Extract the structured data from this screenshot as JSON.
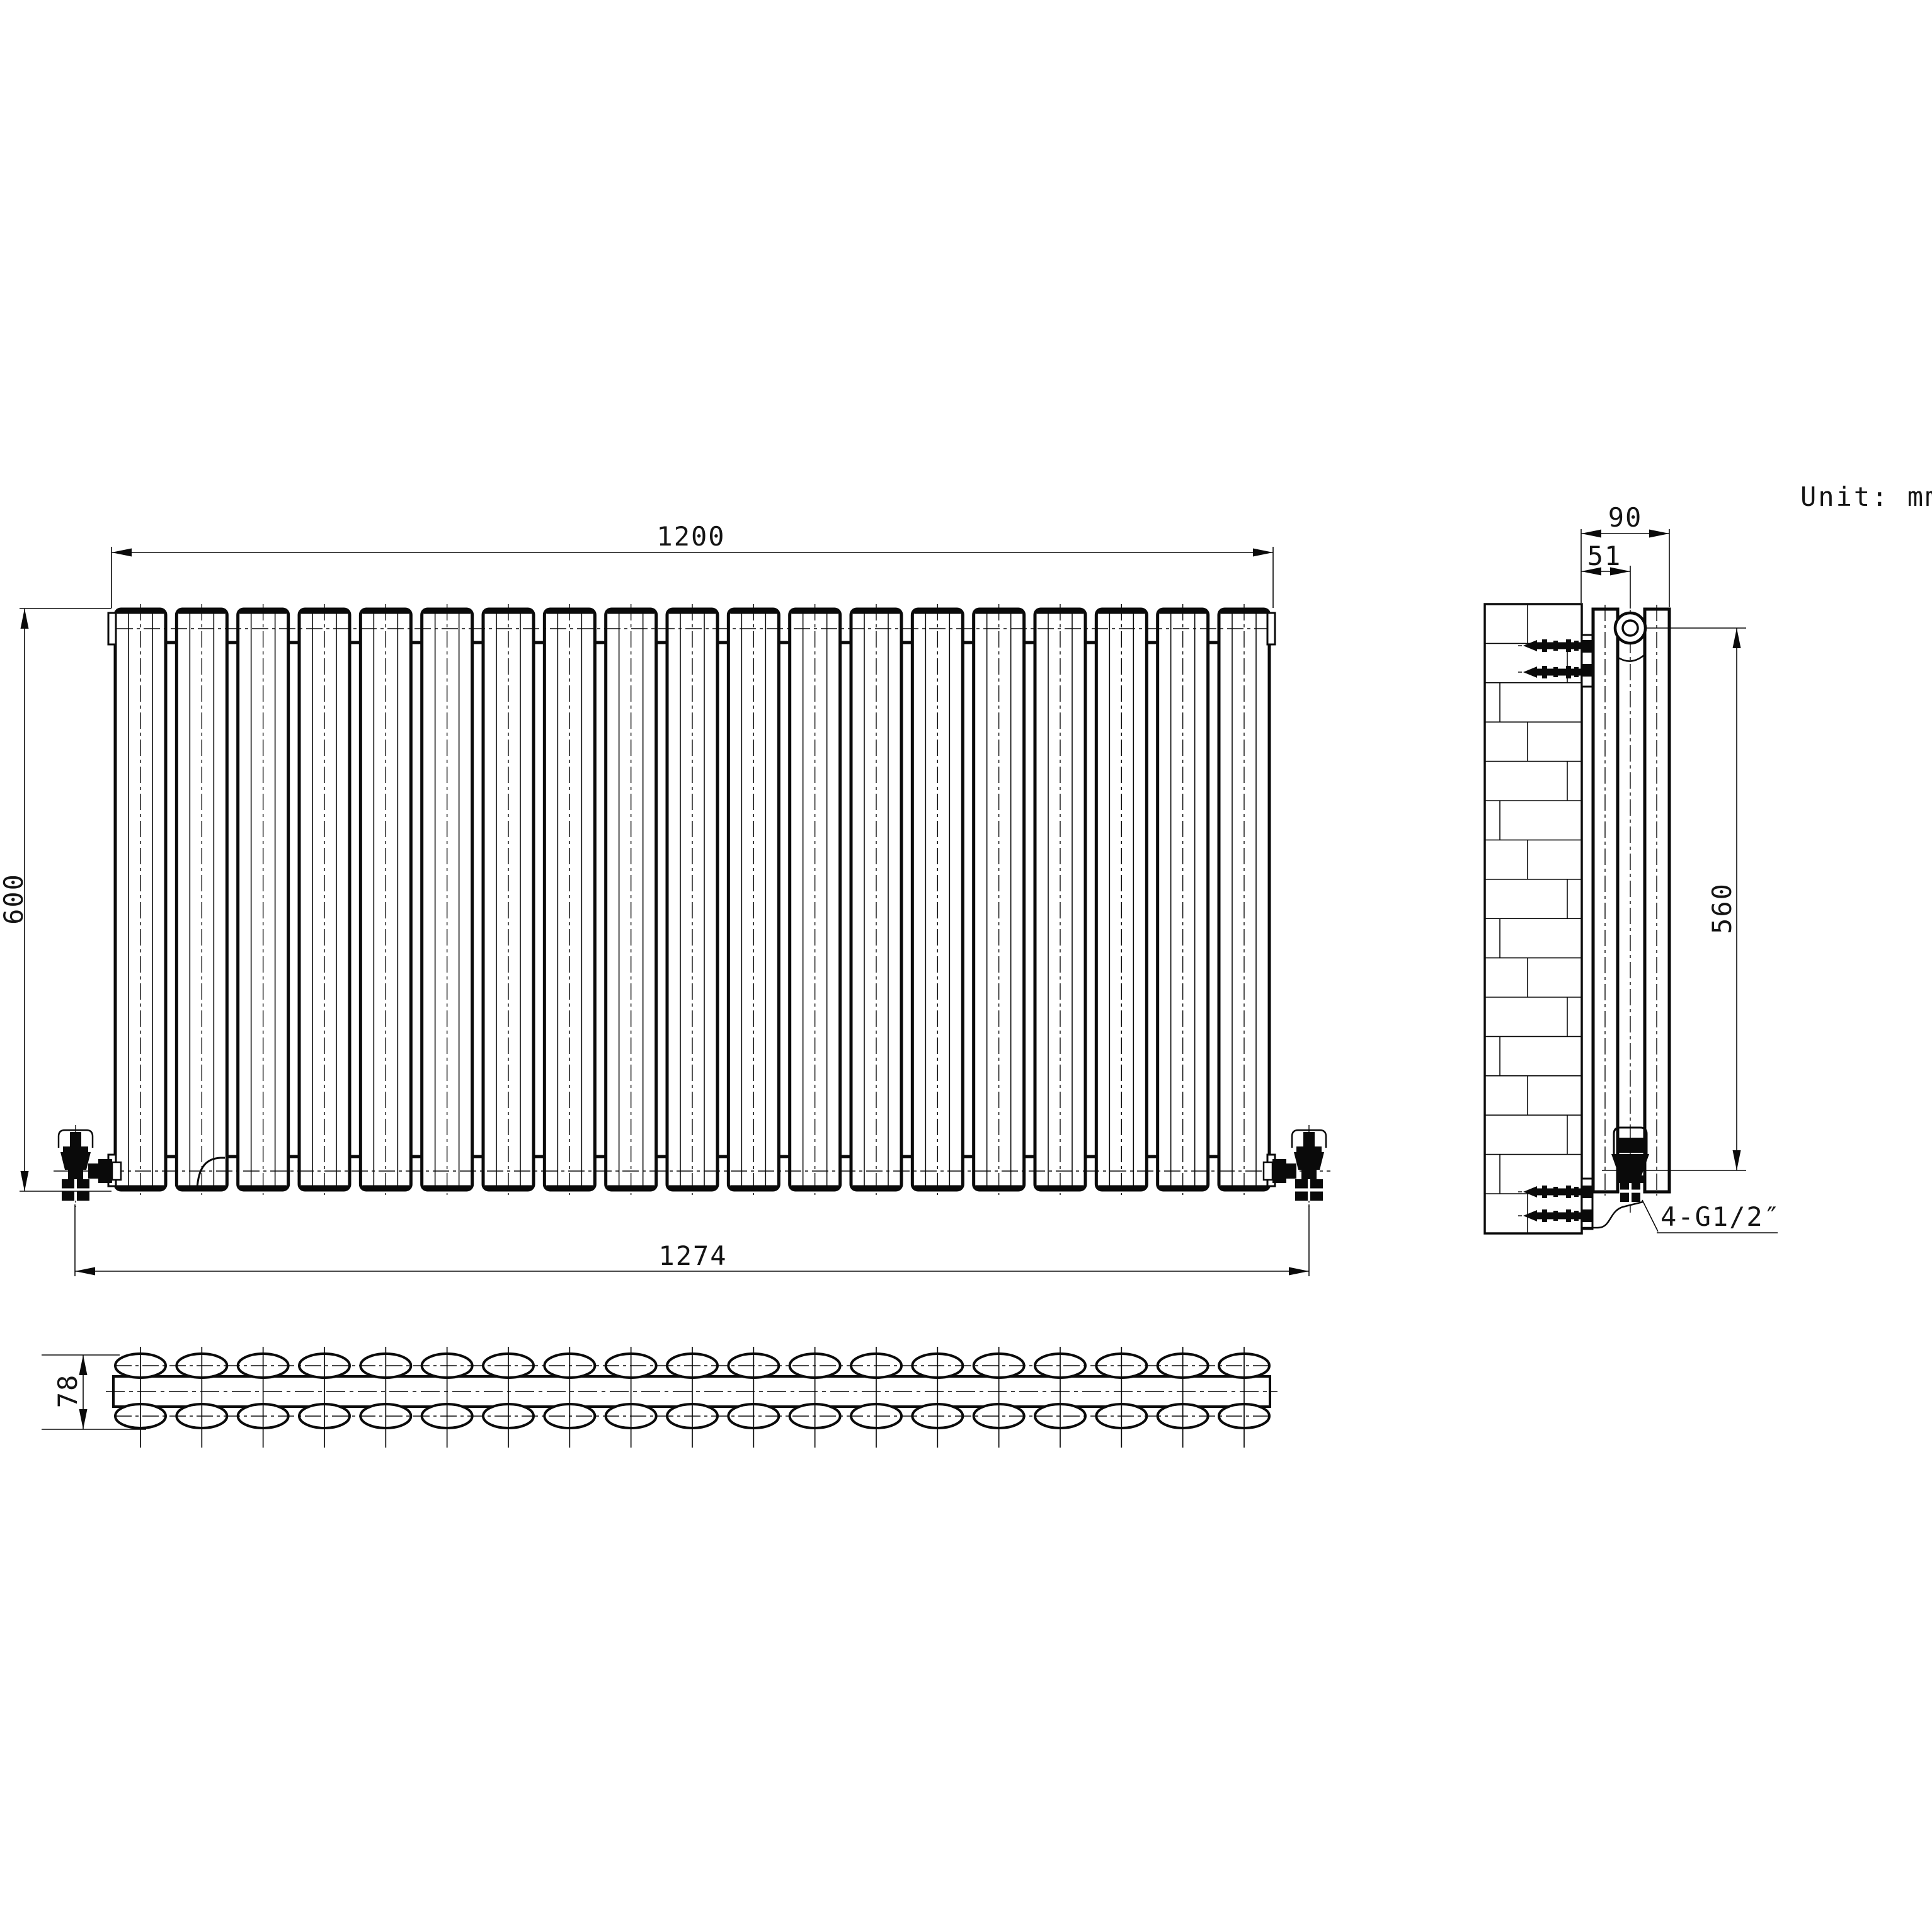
{
  "unit_label": "Unit: mm",
  "colors": {
    "line": "#0a0a0a",
    "background": "#ffffff"
  },
  "front_view": {
    "panel_count": 19,
    "width_label": "1200",
    "height_label": "600",
    "valve_span_label": "1274"
  },
  "side_view": {
    "depth_label": "90",
    "wall_offset_label": "51",
    "port_span_label": "560",
    "thread_label": "4-G1/2″"
  },
  "plan_view": {
    "column_count": 19,
    "row_count": 2,
    "depth_label": "78"
  }
}
